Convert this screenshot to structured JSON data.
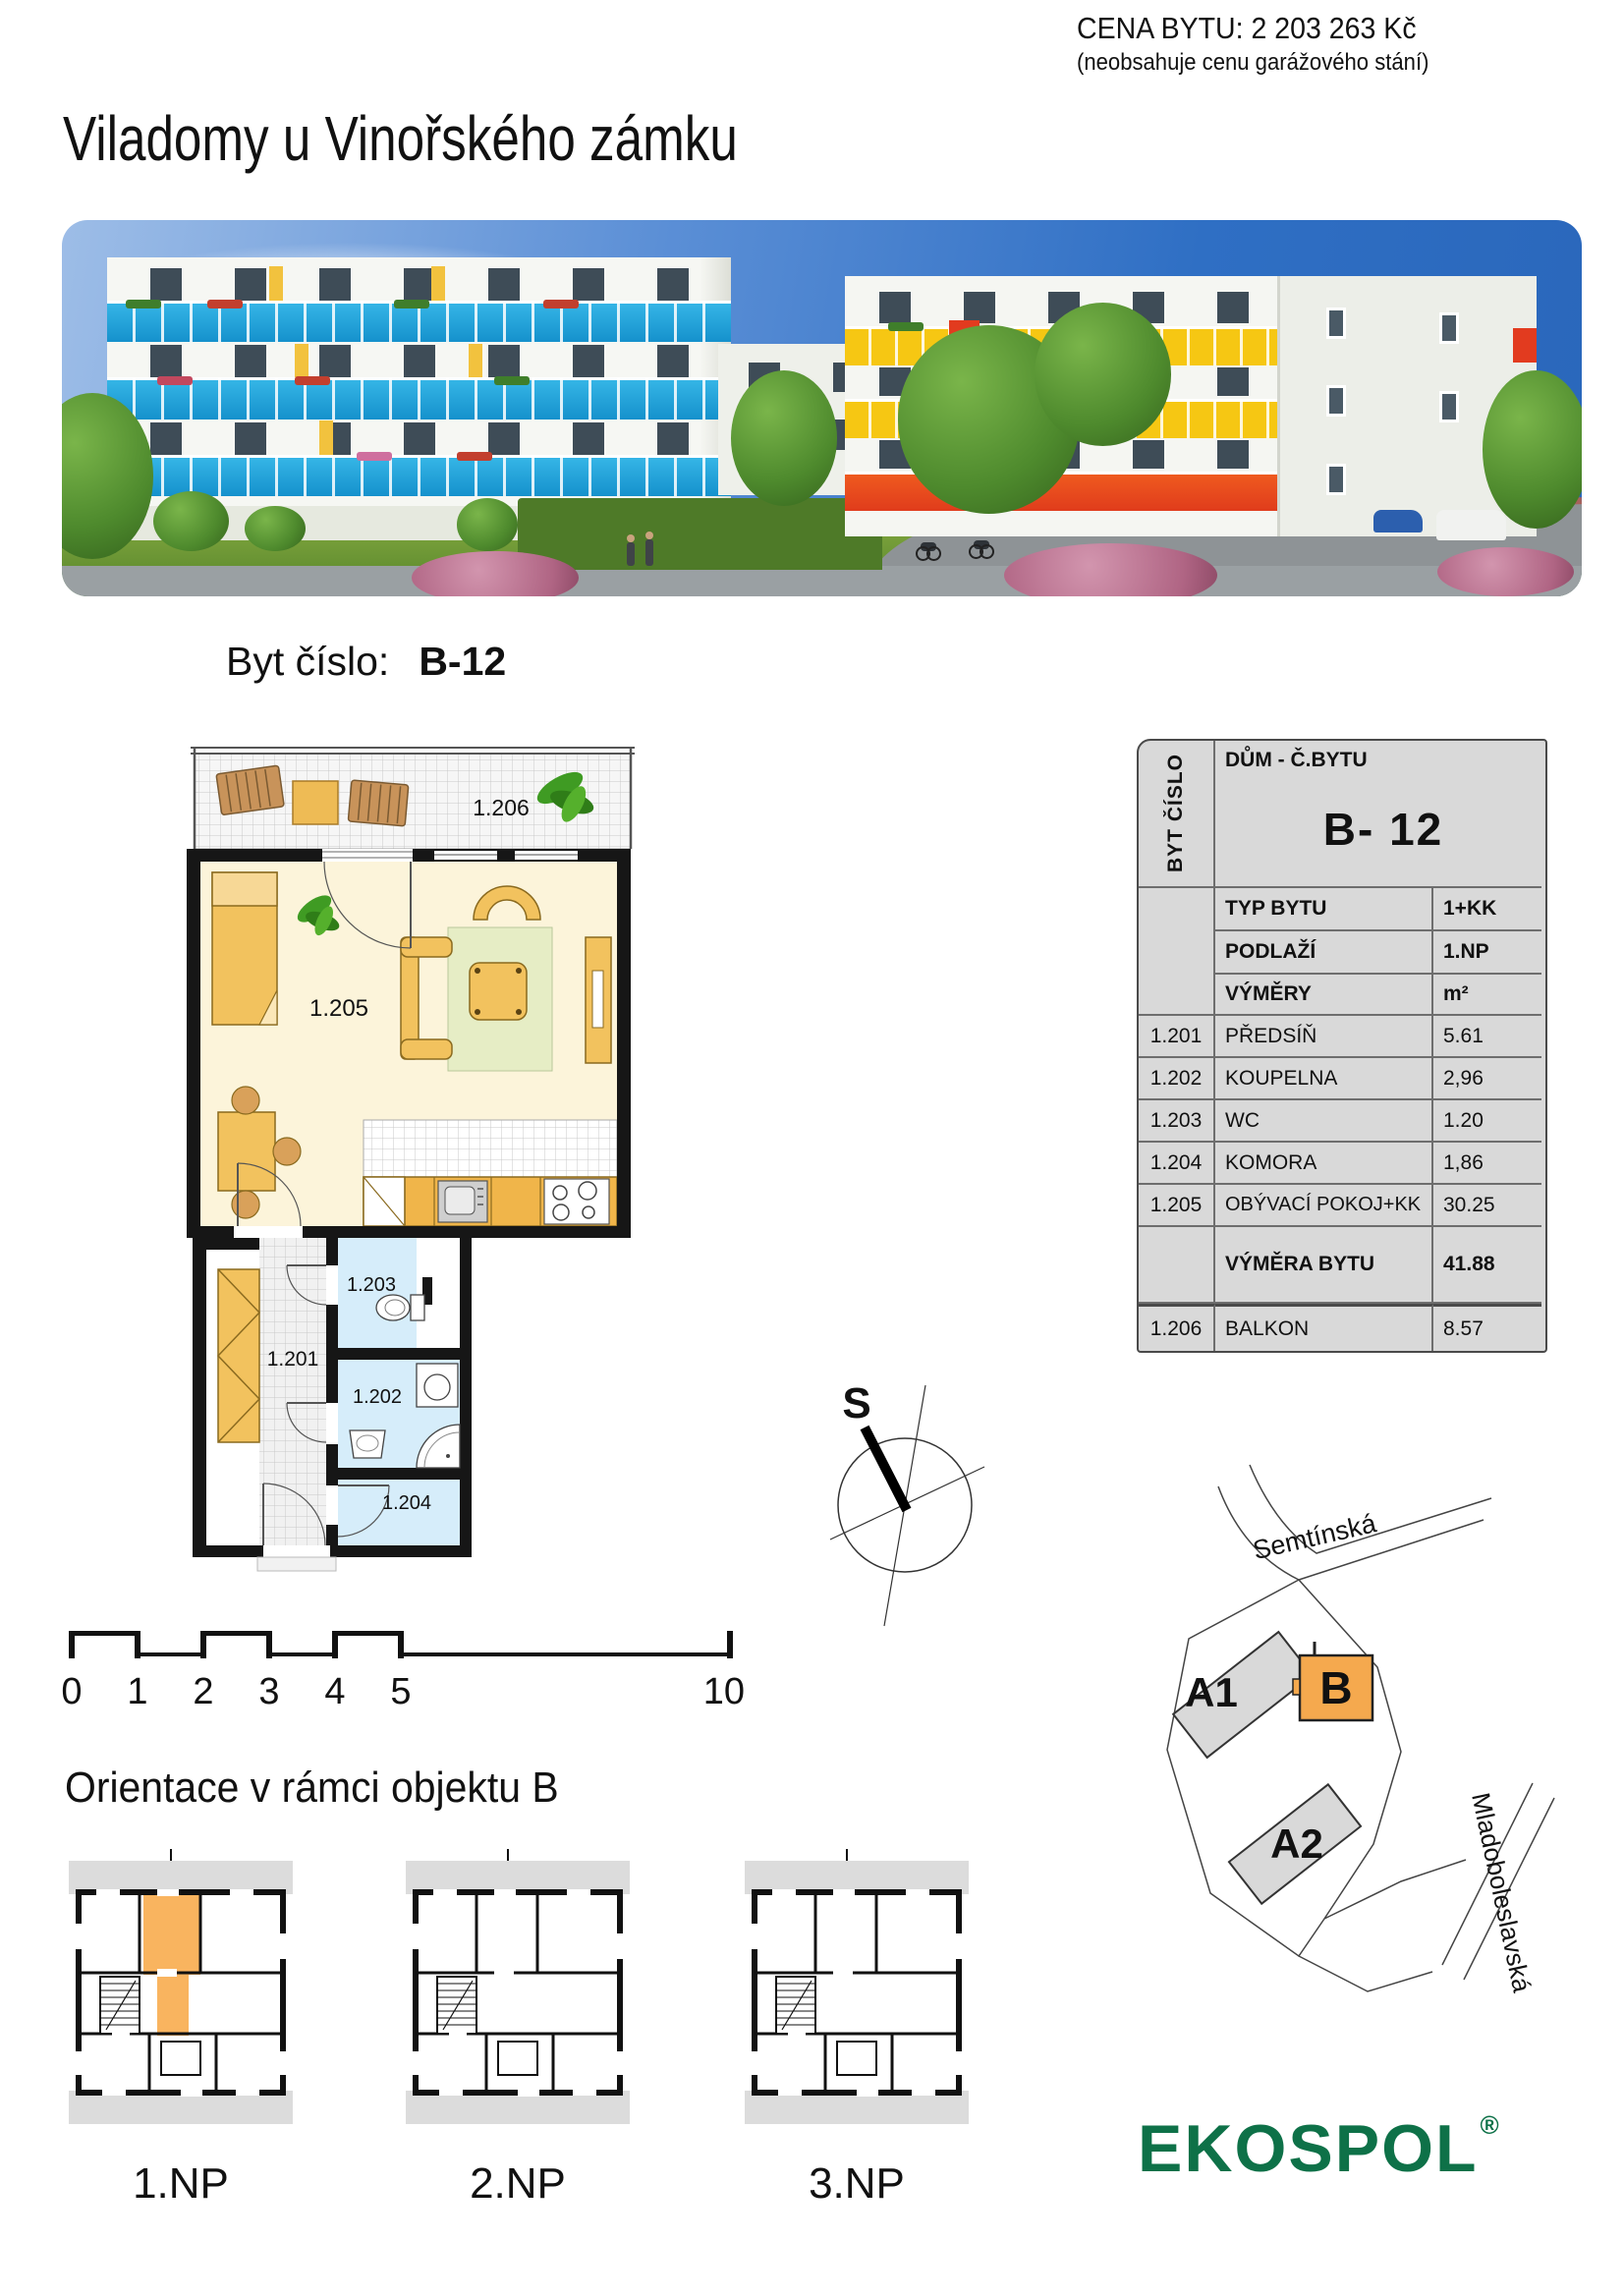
{
  "header": {
    "price_line1": "CENA BYTU: 2 203 263 Kč",
    "price_line2": "(neobsahuje cenu garážového stání)",
    "title": "Viladomy u Vinořského zámku"
  },
  "apartment": {
    "label": "Byt číslo:",
    "number": "B-12"
  },
  "info_table": {
    "corner": "BYT ČÍSLO",
    "header": "DŮM - Č.BYTU",
    "unit": "B- 12",
    "meta": [
      {
        "label": "TYP BYTU",
        "value": "1+KK"
      },
      {
        "label": "PODLAŽÍ",
        "value": "1.NP"
      },
      {
        "label": "VÝMĚRY",
        "value": "m²"
      }
    ],
    "rooms": [
      {
        "code": "1.201",
        "name": "PŘEDSÍŇ",
        "area": "5.61"
      },
      {
        "code": "1.202",
        "name": "KOUPELNA",
        "area": "2,96"
      },
      {
        "code": "1.203",
        "name": "WC",
        "area": "1.20"
      },
      {
        "code": "1.204",
        "name": "KOMORA",
        "area": "1,86"
      },
      {
        "code": "1.205",
        "name": "OBÝVACÍ POKOJ+KK",
        "area": "30.25"
      }
    ],
    "total": {
      "label": "VÝMĚRA BYTU",
      "value": "41.88"
    },
    "balcony": {
      "code": "1.206",
      "name": "BALKON",
      "area": "8.57"
    }
  },
  "floor_plan": {
    "labels": {
      "balcony": "1.206",
      "living": "1.205",
      "hall": "1.201",
      "wc": "1.203",
      "bathroom": "1.202",
      "storage": "1.204"
    }
  },
  "compass": {
    "north": "S"
  },
  "scale_bar": {
    "ticks": [
      "0",
      "1",
      "2",
      "3",
      "4",
      "5"
    ],
    "end": "10 m"
  },
  "orientation": {
    "heading": "Orientace v rámci objektu B",
    "floors": [
      "1.NP",
      "2.NP",
      "3.NP"
    ]
  },
  "site_map": {
    "street_top": "Semtínská",
    "street_right": "Mladoboleslavská",
    "buildings": {
      "a1": "A1",
      "b": "B",
      "a2": "A2"
    }
  },
  "brand": {
    "logo": "EKOSPOL",
    "mark": "®"
  },
  "colors": {
    "highlight_orange": "#F9B45F",
    "ekospol_green": "#0E7148",
    "balcony_blue": "#1BA3D8",
    "balcony_yellow": "#F6C713",
    "balcony_red": "#E23B1F",
    "table_bg": "#D9D9D9",
    "bath_blue": "#D6EDFA",
    "plan_cream": "#FCF4DA",
    "furniture_orange": "#F2C25E"
  }
}
